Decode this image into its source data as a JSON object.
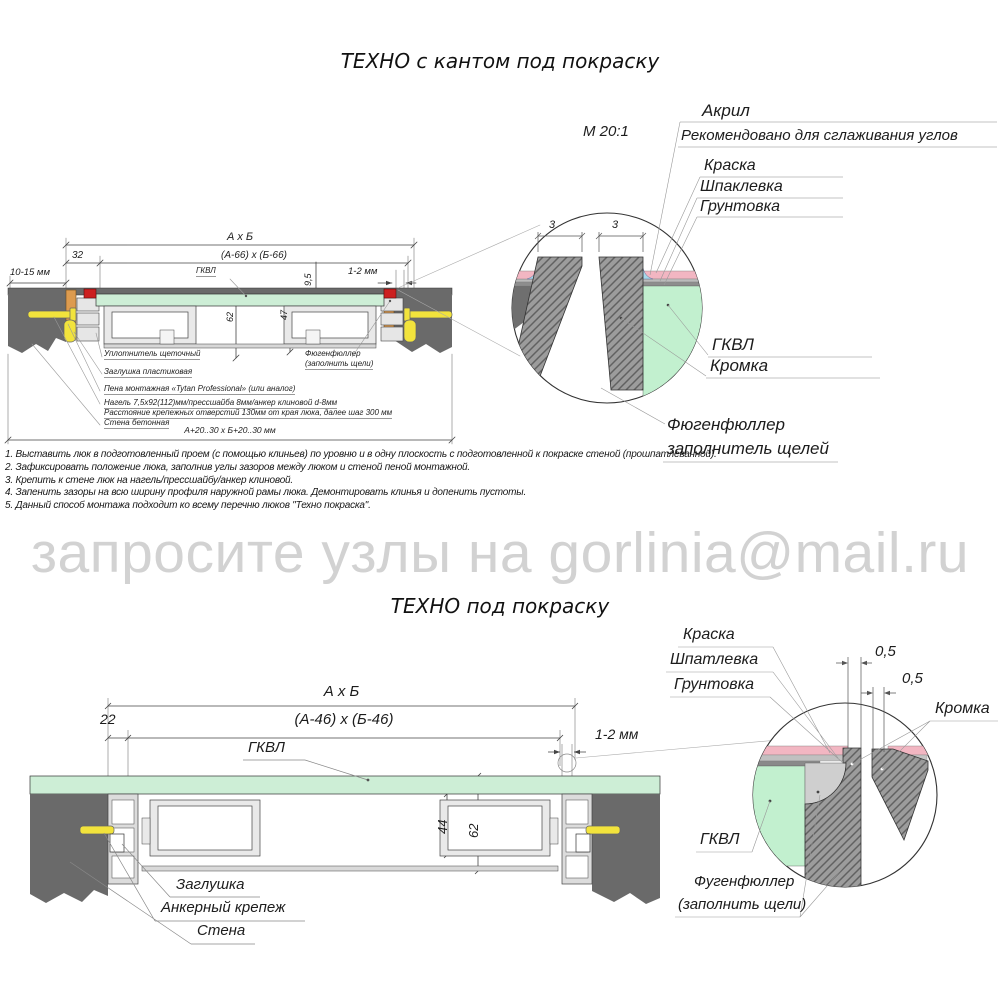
{
  "colors": {
    "wall_gray": "#6a6a6a",
    "panel_green": "#cdeed6",
    "detail_green": "#c2f0cf",
    "paint_pink": "#f2b6c2",
    "acryl_blue": "#a6d8ea",
    "wood_orange": "#dd9b4f",
    "anchor_yellow": "#f2e33c",
    "corner_red": "#cc2020",
    "watermark_gray": "#d2d2d2"
  },
  "top": {
    "title": "ТЕХНО с кантом под покраску",
    "scale": "М 20:1",
    "detail": {
      "acryl": "Акрил",
      "acryl_note": "Рекомендовано для сглаживания углов",
      "paint": "Краска",
      "putty": "Шпаклевка",
      "primer": "Грунтовка",
      "gkvl": "ГКВЛ",
      "edge": "Кромка",
      "filler_line1": "Фюгенфюллер",
      "filler_line2": "заполнитель щелей",
      "gap_left": "3",
      "gap_right": "3"
    },
    "dims": {
      "overall": "А х Б",
      "offset": "32",
      "inner": "(А-66) х (Б-66)",
      "wall_gap": "10-15 мм",
      "panel": "ГКВЛ",
      "depth": "9,5",
      "gap": "1-2 мм",
      "h62": "62",
      "h47": "47",
      "opening": "А+20..30 х Б+20..30 мм"
    },
    "callouts": [
      "Уплотнитель щеточный",
      "Заглушка пластиковая",
      "Пена монтажная «Tytan Professional» (или аналог)",
      "Нагель 7,5х92(112)мм/прессшайба 8мм/анкер клиновой d-8мм",
      "Расстояние крепежных отверстий 130мм от края люка, далее шаг 300 мм",
      "Стена бетонная"
    ],
    "filler_callout_line1": "Фюгенфюллер",
    "filler_callout_line2": "(заполнить щели)"
  },
  "notes": [
    "1. Выставить люк в подготовленный проем (с помощью клиньев) по уровню и в одну плоскость с подготовленной к покраске стеной (прошпатлеванной).",
    "2. Зафиксировать положение люка, заполнив углы зазоров между люком и стеной пеной монтажной.",
    "3. Крепить к стене люк на нагель/прессшайбу/анкер клиновой.",
    "4. Запенить зазоры на всю ширину профиля наружной рамы люка. Демонтировать клинья и допенить пустоты.",
    "5. Данный способ монтажа подходит ко всему перечню люков \"Техно покраска\"."
  ],
  "watermark": "запросите узлы на gorlinia@mail.ru",
  "bottom": {
    "title": "ТЕХНО под покраску",
    "dims": {
      "overall": "А х Б",
      "offset": "22",
      "inner": "(А-46) х (Б-46)",
      "panel": "ГКВЛ",
      "gap": "1-2 мм",
      "h44": "44",
      "h62": "62"
    },
    "callouts": [
      "Заглушка",
      "Анкерный крепеж",
      "Стена"
    ],
    "detail": {
      "paint": "Краска",
      "putty": "Шпатлевка",
      "primer": "Грунтовка",
      "d05a": "0,5",
      "d05b": "0,5",
      "edge": "Кромка",
      "gkvl": "ГКВЛ",
      "filler_line1": "Фугенфюллер",
      "filler_line2": "(заполнить щели)"
    }
  }
}
